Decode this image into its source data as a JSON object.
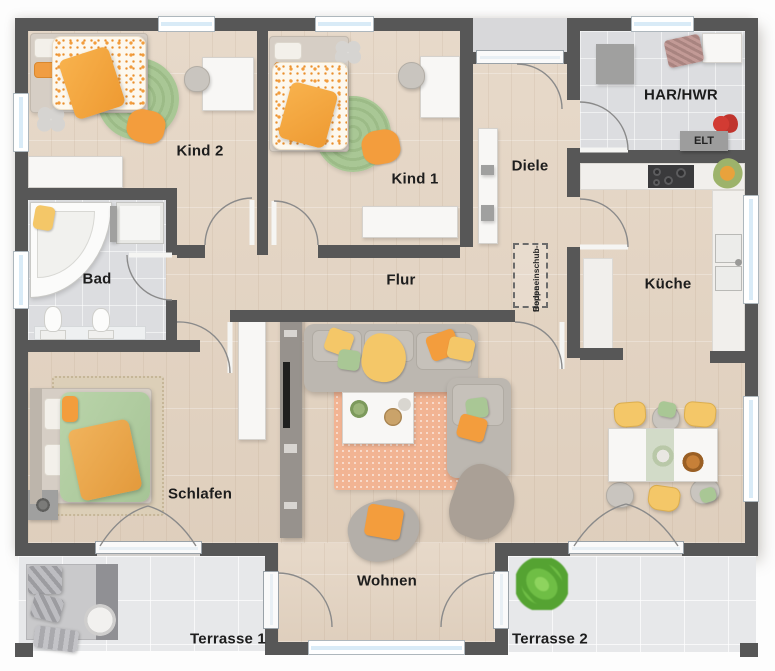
{
  "rooms": {
    "kind2": {
      "label": "Kind 2"
    },
    "kind1": {
      "label": "Kind 1"
    },
    "diele": {
      "label": "Diele"
    },
    "har_hwr": {
      "label": "HAR/HWR"
    },
    "elt": {
      "label": "ELT"
    },
    "bad": {
      "label": "Bad"
    },
    "flur": {
      "label": "Flur"
    },
    "kueche": {
      "label": "Küche"
    },
    "schlafen": {
      "label": "Schlafen"
    },
    "wohnen": {
      "label": "Wohnen"
    },
    "terrasse1": {
      "label": "Terrasse 1"
    },
    "terrasse2": {
      "label": "Terrasse 2"
    },
    "attic_stairs": {
      "label_line1": "Bodeneinschub-",
      "label_line2": "treppe"
    }
  },
  "colors": {
    "wall": "#575757",
    "wood": "#e5d6c5",
    "tile": "#dcdde0",
    "terrace": "#e7e8ea",
    "porch": "#d8d8da",
    "orange": "#f39d3d",
    "yellow": "#f4c768",
    "green": "#a9c795",
    "salmon": "#f2b493",
    "rugbeige": "#dccfb8",
    "glass": "#d9ebf7",
    "sofa": "#bcb7b0",
    "plant": "#6fbe45"
  }
}
